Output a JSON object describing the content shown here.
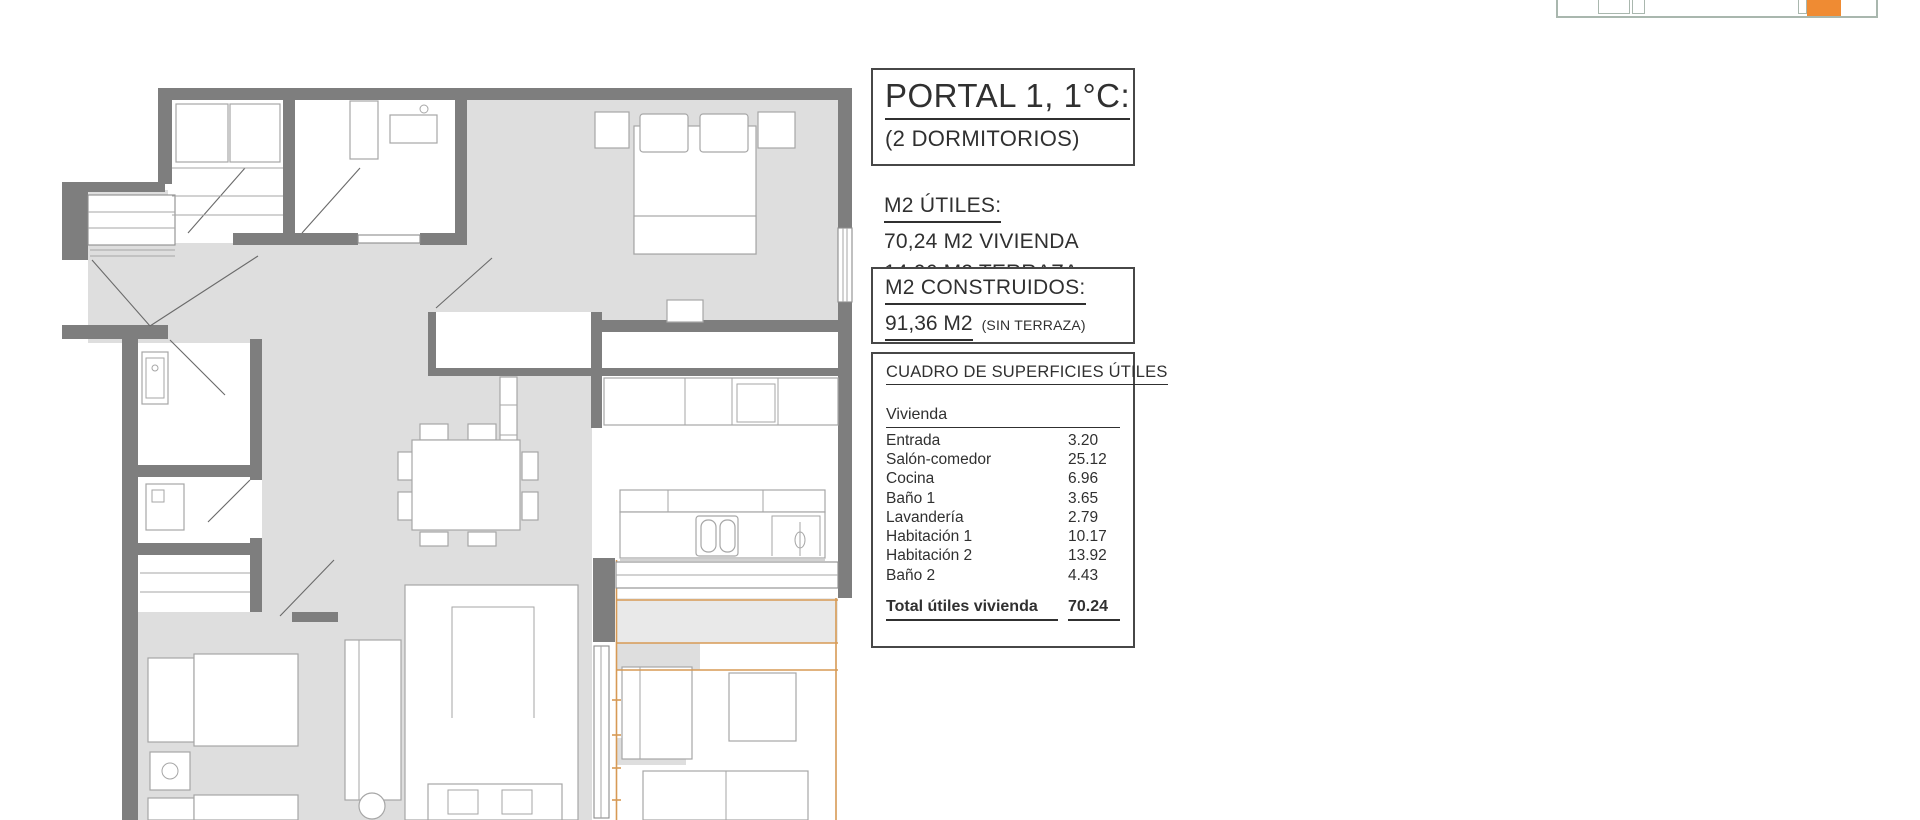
{
  "panel": {
    "title": "PORTAL 1, 1°C:",
    "subtitle": "(2 DORMITORIOS)",
    "utiles": {
      "heading": "M2 ÚTILES:",
      "line1": "70,24 M2 VIVIENDA",
      "line2": "14,06 M2 TERRAZA"
    },
    "construidos": {
      "heading": "M2 CONSTRUIDOS:",
      "value": "91,36 M2",
      "note": "(SIN TERRAZA)"
    },
    "table": {
      "heading": "CUADRO DE SUPERFICIES ÚTILES",
      "group": "Vivienda",
      "rows": [
        [
          "Entrada",
          "3.20"
        ],
        [
          "Salón-comedor",
          "25.12"
        ],
        [
          "Cocina",
          "6.96"
        ],
        [
          "Baño 1",
          "3.65"
        ],
        [
          "Lavandería",
          "2.79"
        ],
        [
          "Habitación 1",
          "10.17"
        ],
        [
          "Habitación 2",
          "13.92"
        ],
        [
          "Baño 2",
          "4.43"
        ]
      ],
      "total_label": "Total útiles vivienda",
      "total_value": "70.24"
    }
  },
  "colors": {
    "ink": "#303030",
    "wall": "#7e7e7e",
    "floor": "#dedede",
    "line": "#a6a6a6",
    "accent": "#ef8b33",
    "tline": "#d79a55",
    "keyline": "#a9b7ae"
  }
}
